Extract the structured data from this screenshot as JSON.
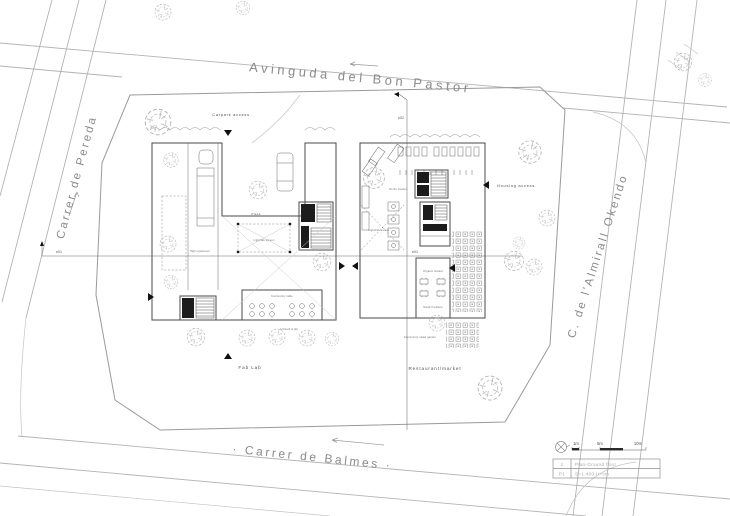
{
  "streets": {
    "top": "Avinguda del Bon Pastor",
    "left": "Carrer de Pereda",
    "right": "C. de l'Almirall Okendo",
    "bottom": "· Carrer de Balmes ·"
  },
  "annotations": {
    "carpark_access": "Carpark access",
    "housing_access": "Housing access",
    "fab_lab": "Fab Lab",
    "restaurant_market": "Restaurant/market",
    "plaza": "Plaza",
    "light_fab_screen": "Light/fab screen",
    "light_fab_access": "Light/fab access",
    "herbs_market": "Herbs market",
    "organic_market": "Organic market",
    "small_fireplace": "Small fireplace",
    "community_table": "Community table",
    "community_salad_garden": "Community salad garden",
    "high_equipment": "High equipment",
    "art_lab": "Art/park & lab"
  },
  "sections": {
    "e01": "e01",
    "e02": "e02"
  },
  "legend": {
    "north_icon": "compass-north-icon",
    "scale_ticks": {
      "m1": "1m",
      "m5": "5m",
      "m10": "10m"
    },
    "title_row1_id": "1",
    "title_row1_text": "Plan-Ground floor",
    "title_row2_id": "P1",
    "title_row2_text": "S=1:400  U=cm"
  },
  "colors": {
    "background": "#ffffff",
    "drawing_line": "#4a4a4a",
    "road_line": "#b3b3b3",
    "street_text": "#8b8b8b",
    "core_fill": "#1c1c1c"
  }
}
